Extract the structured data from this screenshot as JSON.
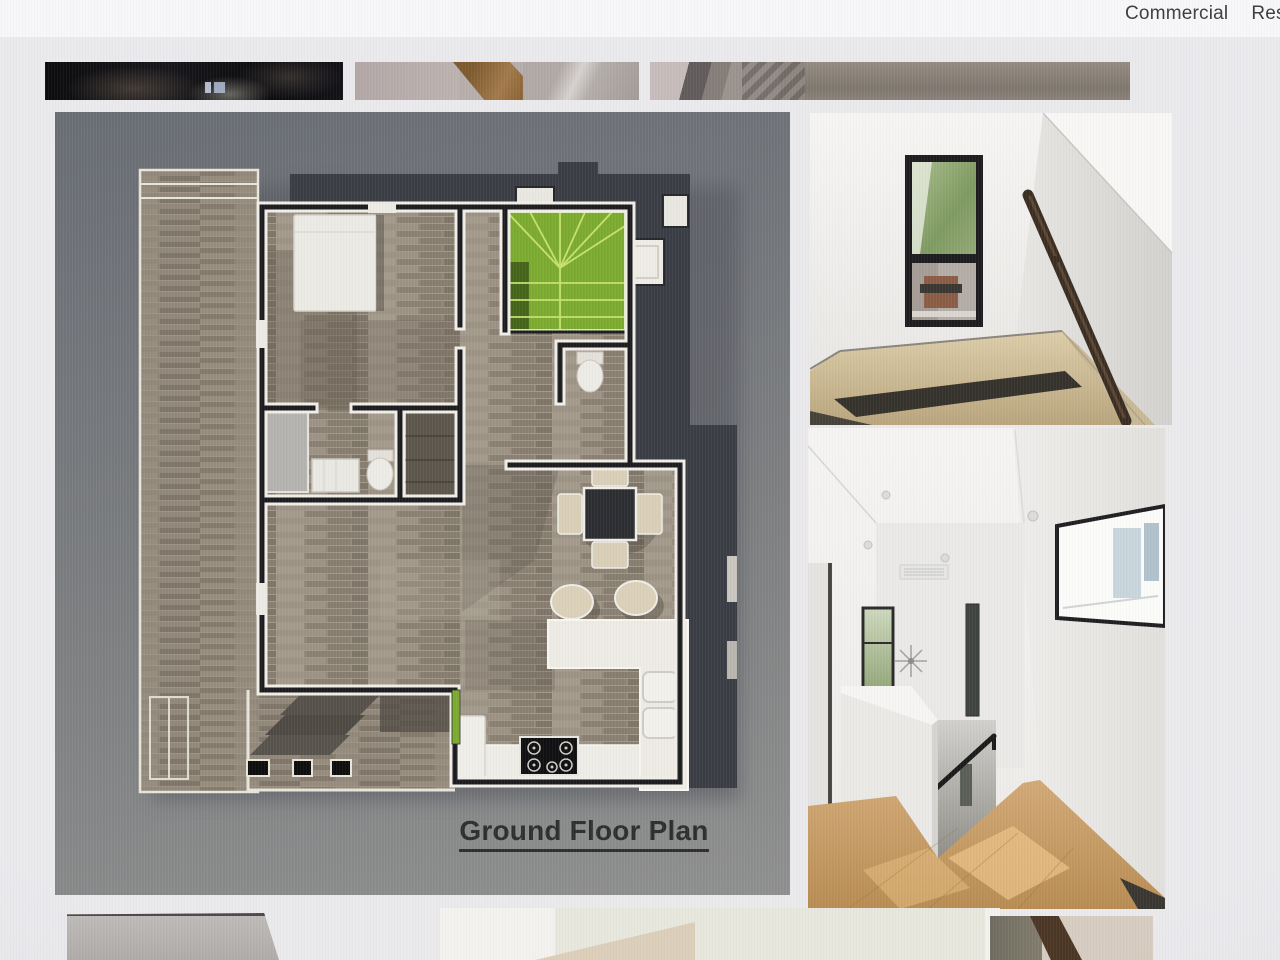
{
  "header": {
    "nav": [
      {
        "label": "Commercial"
      },
      {
        "label": "Res"
      }
    ]
  },
  "plan": {
    "title": "Ground Floor Plan"
  },
  "gallery": {
    "top_thumbnails": [
      "dark-exterior-photo",
      "stair-base-photo",
      "staircase-photo"
    ],
    "side_photos": [
      "stair-landing-window-photo",
      "upper-hallway-photo"
    ],
    "bottom_thumbnails": [
      "counter-photo",
      "white-interior-photo",
      "wood-beam-photo"
    ]
  },
  "colors": {
    "page_bg": "#eae9ec",
    "header_bg": "#f7f6f8",
    "nav_text": "#3d3d3d",
    "panel_top": "#696d74",
    "panel_mid": "#7c7e80",
    "panel_bottom": "#8e8f8e",
    "roof": "#3a3d44",
    "stair_green": "#7cab2f",
    "wall_black": "#1c1c1f",
    "wall_white": "#f0eee7",
    "title": "#2e2e2e"
  }
}
